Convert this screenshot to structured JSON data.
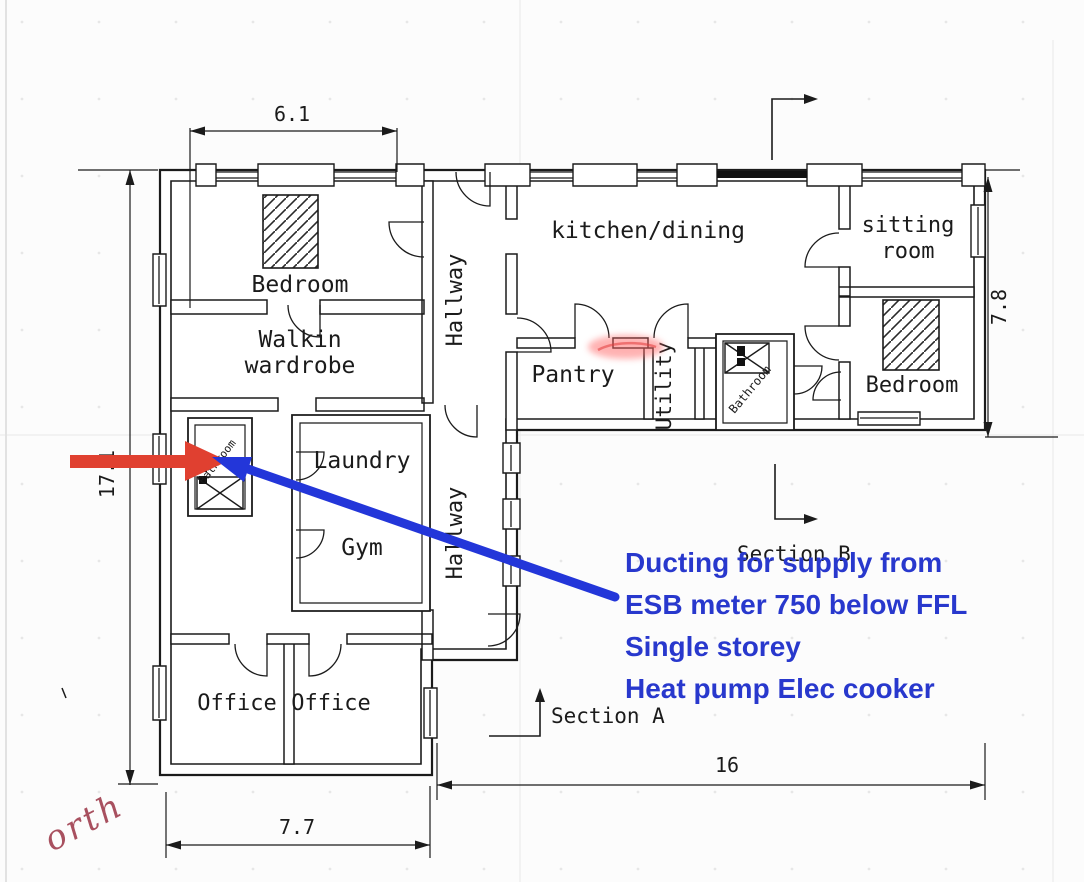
{
  "rooms": {
    "bedroom_left": "Bedroom",
    "walkin_line1": "Walkin",
    "walkin_line2": "wardrobe",
    "hallway_upper": "Hallway",
    "kitchen_dining": "kitchen/dining",
    "sitting_line1": "sitting",
    "sitting_line2": "room",
    "pantry": "Pantry",
    "utility": "Utility",
    "bathroom_main": "Bathroom",
    "bedroom_right": "Bedroom",
    "bathroom_small": "Bathroom",
    "laundry": "Laundry",
    "gym": "Gym",
    "hallway_lower": "Hallway",
    "office_left": "Office",
    "office_right": "Office"
  },
  "dimensions": {
    "top_width": "6.1",
    "left_height": "17.1",
    "right_height": "7.8",
    "bottom_total": "16",
    "bottom_left_width": "7.7"
  },
  "sections": {
    "a": "Section A",
    "b": "Section B"
  },
  "note": {
    "lines": [
      "Ducting for supply from",
      "ESB meter 750 below FFL",
      "Single storey",
      "Heat pump Elec cooker"
    ],
    "color": "#2838cd"
  },
  "north_label": "orth",
  "colors": {
    "wall": "#1b1b1b",
    "red_arrow": "#e04030",
    "blue_arrow": "#2336d9",
    "highlight": "#ff6666",
    "north_text": "#a8505f"
  }
}
